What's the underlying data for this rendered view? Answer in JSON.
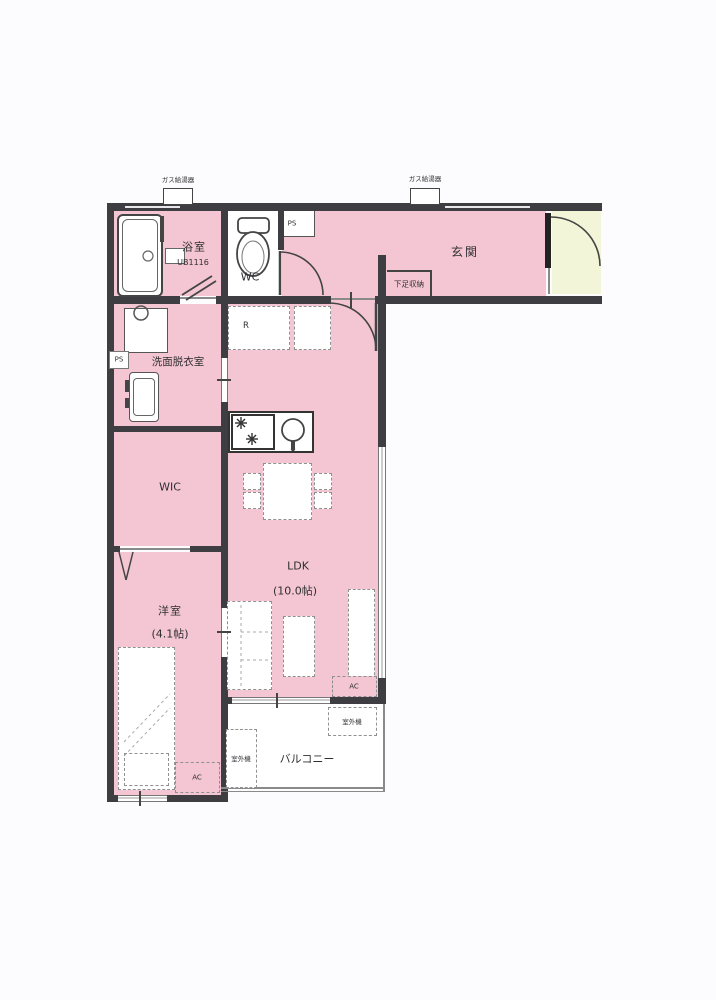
{
  "plan": {
    "rooms": {
      "bath": {
        "label": "浴室",
        "unit": "UB1116"
      },
      "wc": {
        "label": "WC"
      },
      "entrance": {
        "label": "玄関",
        "shoe_storage": "下足収納"
      },
      "washroom": {
        "label": "洗面脱衣室"
      },
      "wic": {
        "label": "WIC"
      },
      "bedroom": {
        "label": "洋室",
        "size": "(4.1帖)"
      },
      "ldk": {
        "label": "LDK",
        "size": "(10.0帖)"
      },
      "balcony": {
        "label": "バルコニー"
      }
    },
    "equipment": {
      "water_heater": "ガス給湯器",
      "pipe_space": "PS",
      "refrigerator": "R",
      "air_conditioner": "AC",
      "outdoor_unit": "室外機"
    },
    "colors": {
      "room_fill": "#f4c6d3",
      "entrance_porch": "#f3f5d8",
      "wall": "#3e3e42",
      "fixture_white": "#ffffff"
    }
  }
}
